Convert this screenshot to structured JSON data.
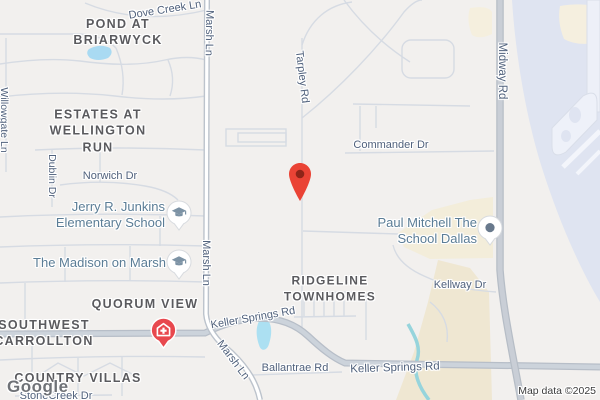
{
  "attribution": {
    "text": "Map data ©2025"
  },
  "logo": {
    "text": "Google"
  },
  "marker": {
    "type": "dropped-pin",
    "color": "#ea4335"
  },
  "areas": {
    "pond_briarwyck": {
      "line1": "POND AT",
      "line2": "BRIARWYCK"
    },
    "estates": {
      "line1": "ESTATES AT",
      "line2": "WELLINGTON",
      "line3": "RUN"
    },
    "quorum_view": {
      "line1": "QUORUM VIEW"
    },
    "southwest_carrollton": {
      "line1": "SOUTHWEST",
      "line2": "CARROLLTON"
    },
    "country_villas": {
      "line1": "COUNTRY VILLAS"
    },
    "ridgeline": {
      "line1": "RIDGELINE",
      "line2": "TOWNHOMES"
    }
  },
  "streets": {
    "dove_creek_ln": "Dove Creek Ln",
    "marsh_ln_top": "Marsh Ln",
    "willowgate_ln": "Willowgate Ln",
    "dublin_dr": "Dublin Dr",
    "norwich_dr": "Norwich Dr",
    "marsh_ln_mid": "Marsh Ln",
    "stonecreek_dr": "StoneCreek Dr",
    "tarpley_rd": "Tarpley Rd",
    "commander_dr": "Commander Dr",
    "midway_rd": "Midway Rd",
    "kellway_dr": "Kellway Dr",
    "keller_springs_w": "Keller Springs Rd",
    "marsh_ln_bottom": "Marsh Ln",
    "ballantrae_rd": "Ballantrae Rd",
    "keller_springs_e": "Keller Springs Rd"
  },
  "pois": {
    "junkins": {
      "line1": "Jerry R. Junkins",
      "line2": "Elementary School",
      "icon": "graduation-cap"
    },
    "madison": {
      "line1": "The Madison on Marsh",
      "icon": "graduation-cap"
    },
    "paul_mitchell": {
      "line1": "Paul Mitchell The",
      "line2": "School Dallas",
      "icon": "generic-dot"
    },
    "hospital": {
      "icon": "hospital-cross"
    }
  },
  "colors": {
    "land": "#f2f0ee",
    "road_major_fill": "#ccd3db",
    "road_major_casing": "#b7bec8",
    "road_minor": "#d6dbe3",
    "water": "#a9daf2",
    "creek": "#96d4dc",
    "airport_apron": "#dfe4f1",
    "commercial_cream": "#f3edda",
    "open_land_tan": "#efe7d2",
    "street_label": "#50617c",
    "area_label": "#5a5a5e",
    "poi_label": "#5b7d96",
    "marker_red": "#ea4335",
    "marker_inner": "#8e2418",
    "hospital_red": "#e8484e",
    "poi_icon_gray": "#7d93a5"
  }
}
